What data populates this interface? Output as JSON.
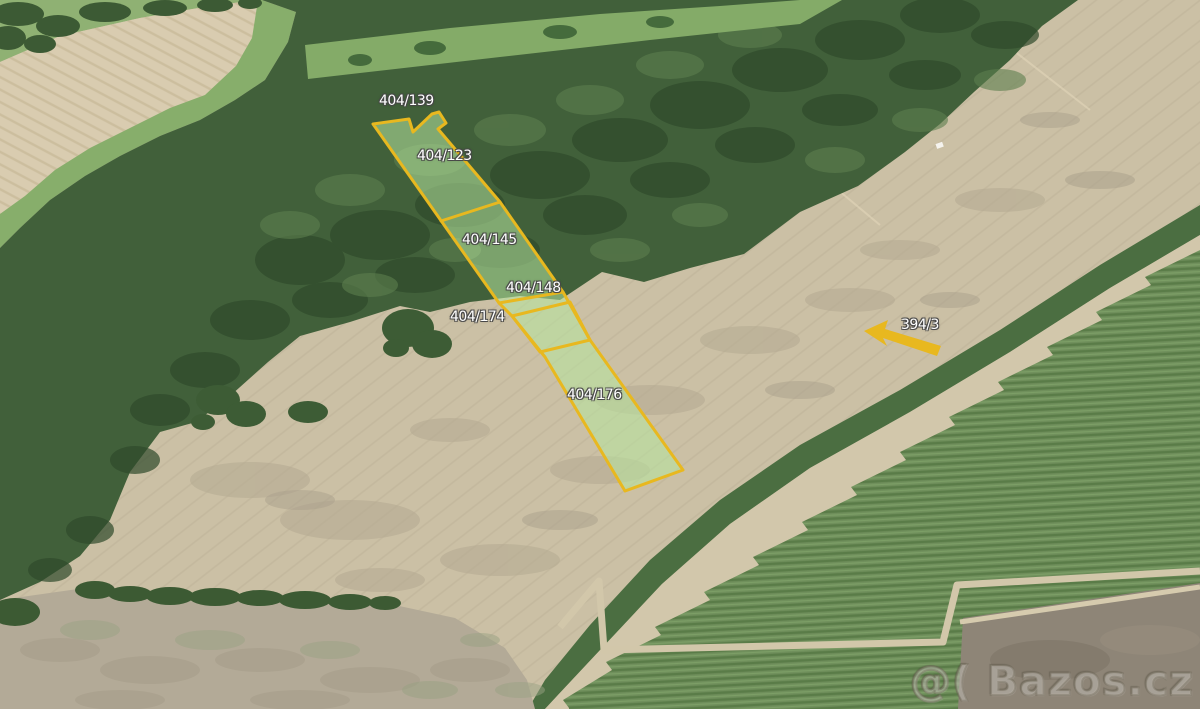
{
  "map": {
    "description": "Aerial cadastral photo with highlighted land parcels for sale",
    "watermark": "@( Bazos.cz",
    "highlight": {
      "outline_color": "#e8b81f",
      "fill_color": "#b7e69e",
      "label_color": "#ffffff"
    },
    "parcels": {
      "items": [
        {
          "label": "404/139"
        },
        {
          "label": "404/123"
        },
        {
          "label": "404/145"
        },
        {
          "label": "404/148"
        },
        {
          "label": "404/174"
        },
        {
          "label": "404/176"
        },
        {
          "label": "394/3"
        }
      ]
    }
  }
}
